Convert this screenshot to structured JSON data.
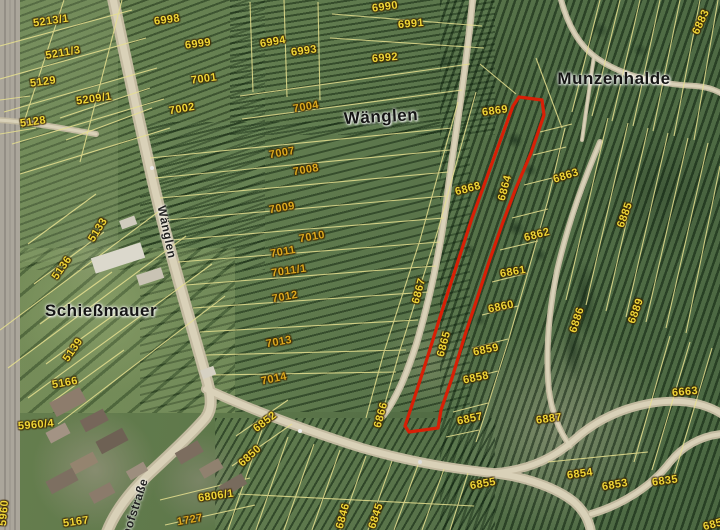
{
  "map": {
    "highlight_color": "#d81f06",
    "place_labels": [
      {
        "t": "Wänglen",
        "x": 381,
        "y": 117,
        "r": -3
      },
      {
        "t": "Munzenhalde",
        "x": 614,
        "y": 79,
        "r": 0
      },
      {
        "t": "Schießmauer",
        "x": 101,
        "y": 311,
        "r": 0
      }
    ],
    "street_labels": [
      {
        "t": "Wänglen",
        "x": 167,
        "y": 232,
        "r": 78
      },
      {
        "t": "hofstraße",
        "x": 135,
        "y": 507,
        "r": -72
      }
    ],
    "parcel_labels": [
      {
        "t": "5213/1",
        "x": 51,
        "y": 21,
        "r": -8
      },
      {
        "t": "6998",
        "x": 167,
        "y": 20,
        "r": -8
      },
      {
        "t": "6999",
        "x": 198,
        "y": 44,
        "r": -8
      },
      {
        "t": "5211/3",
        "x": 63,
        "y": 53,
        "r": -10
      },
      {
        "t": "7001",
        "x": 204,
        "y": 79,
        "r": -8
      },
      {
        "t": "5129",
        "x": 43,
        "y": 82,
        "r": -8
      },
      {
        "t": "5209/1",
        "x": 94,
        "y": 99,
        "r": -8
      },
      {
        "t": "7002",
        "x": 182,
        "y": 109,
        "r": -10
      },
      {
        "t": "5128",
        "x": 33,
        "y": 122,
        "r": -8
      },
      {
        "t": "6990",
        "x": 385,
        "y": 7,
        "r": -8
      },
      {
        "t": "6991",
        "x": 411,
        "y": 24,
        "r": -5
      },
      {
        "t": "6994",
        "x": 273,
        "y": 42,
        "r": -10
      },
      {
        "t": "6993",
        "x": 304,
        "y": 51,
        "r": -8
      },
      {
        "t": "6992",
        "x": 385,
        "y": 58,
        "r": -5
      },
      {
        "t": "7004",
        "x": 306,
        "y": 107,
        "r": -10,
        "c": "a"
      },
      {
        "t": "6883",
        "x": 701,
        "y": 22,
        "r": -65
      },
      {
        "t": "6869",
        "x": 495,
        "y": 111,
        "r": -8
      },
      {
        "t": "7007",
        "x": 282,
        "y": 153,
        "r": -10,
        "c": "a"
      },
      {
        "t": "7008",
        "x": 306,
        "y": 170,
        "r": -10,
        "c": "a"
      },
      {
        "t": "6868",
        "x": 468,
        "y": 189,
        "r": -15
      },
      {
        "t": "6864",
        "x": 505,
        "y": 188,
        "r": -75
      },
      {
        "t": "6863",
        "x": 566,
        "y": 176,
        "r": -18
      },
      {
        "t": "7009",
        "x": 282,
        "y": 208,
        "r": -10,
        "c": "a"
      },
      {
        "t": "6885",
        "x": 625,
        "y": 215,
        "r": -70
      },
      {
        "t": "7010",
        "x": 312,
        "y": 237,
        "r": -10,
        "c": "a"
      },
      {
        "t": "7011",
        "x": 283,
        "y": 252,
        "r": -10,
        "c": "a"
      },
      {
        "t": "6862",
        "x": 537,
        "y": 235,
        "r": -15
      },
      {
        "t": "5133",
        "x": 98,
        "y": 230,
        "r": -58
      },
      {
        "t": "7011/1",
        "x": 289,
        "y": 271,
        "r": -8,
        "c": "a"
      },
      {
        "t": "6861",
        "x": 513,
        "y": 272,
        "r": -10
      },
      {
        "t": "5136",
        "x": 62,
        "y": 268,
        "r": -55
      },
      {
        "t": "6867",
        "x": 419,
        "y": 291,
        "r": -75
      },
      {
        "t": "7012",
        "x": 285,
        "y": 297,
        "r": -10,
        "c": "a"
      },
      {
        "t": "6860",
        "x": 501,
        "y": 307,
        "r": -12
      },
      {
        "t": "6886",
        "x": 577,
        "y": 320,
        "r": -72
      },
      {
        "t": "6889",
        "x": 636,
        "y": 311,
        "r": -70
      },
      {
        "t": "5139",
        "x": 73,
        "y": 350,
        "r": -55
      },
      {
        "t": "7013",
        "x": 279,
        "y": 342,
        "r": -10,
        "c": "a"
      },
      {
        "t": "6865",
        "x": 444,
        "y": 344,
        "r": -75
      },
      {
        "t": "6859",
        "x": 486,
        "y": 350,
        "r": -12
      },
      {
        "t": "5166",
        "x": 65,
        "y": 383,
        "r": -10
      },
      {
        "t": "7014",
        "x": 274,
        "y": 379,
        "r": -12,
        "c": "a"
      },
      {
        "t": "6858",
        "x": 476,
        "y": 378,
        "r": -12
      },
      {
        "t": "6663",
        "x": 685,
        "y": 392,
        "r": -5
      },
      {
        "t": "5960/4",
        "x": 36,
        "y": 425,
        "r": -5
      },
      {
        "t": "6866",
        "x": 381,
        "y": 415,
        "r": -75
      },
      {
        "t": "6857",
        "x": 470,
        "y": 419,
        "r": -12
      },
      {
        "t": "6887",
        "x": 549,
        "y": 419,
        "r": -8
      },
      {
        "t": "6852",
        "x": 265,
        "y": 422,
        "r": -38
      },
      {
        "t": "6850",
        "x": 250,
        "y": 456,
        "r": -42
      },
      {
        "t": "6855",
        "x": 483,
        "y": 484,
        "r": -10
      },
      {
        "t": "6854",
        "x": 580,
        "y": 474,
        "r": -8
      },
      {
        "t": "6853",
        "x": 615,
        "y": 485,
        "r": -10
      },
      {
        "t": "6835",
        "x": 665,
        "y": 481,
        "r": -8
      },
      {
        "t": "6806/1",
        "x": 216,
        "y": 496,
        "r": -8
      },
      {
        "t": "5167",
        "x": 76,
        "y": 522,
        "r": -8
      },
      {
        "t": "1727",
        "x": 190,
        "y": 520,
        "r": -10,
        "c": "a"
      },
      {
        "t": "6846",
        "x": 343,
        "y": 516,
        "r": -75
      },
      {
        "t": "6845",
        "x": 376,
        "y": 516,
        "r": -72
      },
      {
        "t": "5960",
        "x": 4,
        "y": 513,
        "r": -85
      },
      {
        "t": "6851",
        "x": 716,
        "y": 524,
        "r": -15
      }
    ]
  }
}
